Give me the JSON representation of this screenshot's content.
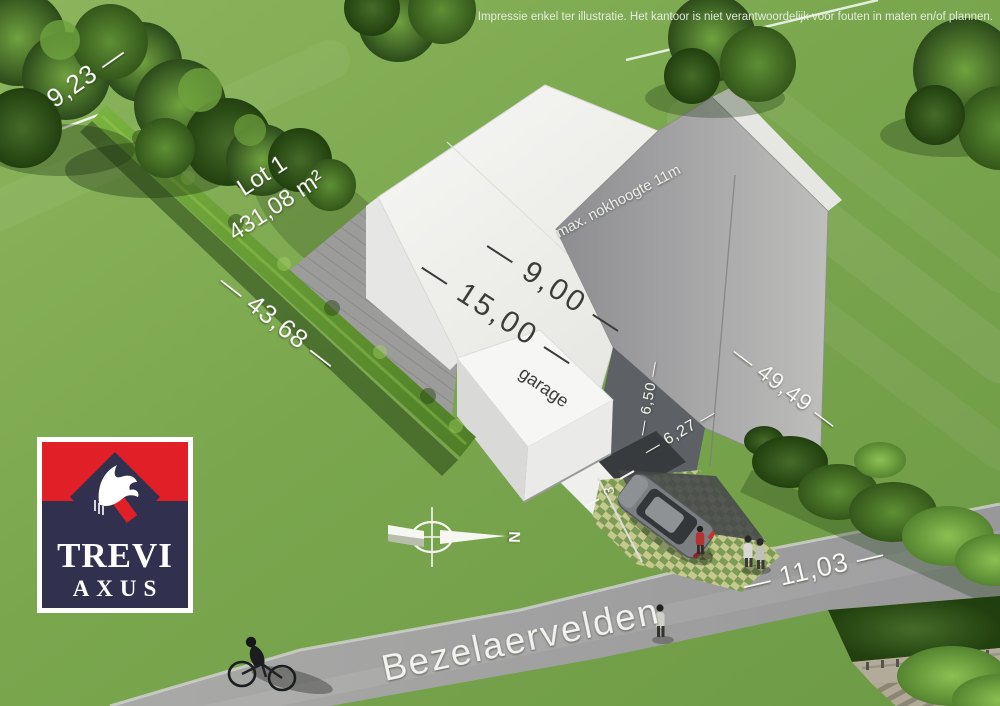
{
  "disclaimer": "Impressie enkel ter illustratie. Het kantoor is niet verantwoordelijk voor fouten in maten en/of plannen.",
  "lot": {
    "label": "Lot 1",
    "area": "431,08 m²"
  },
  "dimensions": {
    "rear": "9,23 —",
    "left": "— 43,68 —",
    "roof_depth": "— 9,00 —",
    "roof_width": "— 15,00 —",
    "ridge_note": "max. nokhoogte 11m",
    "garage": "garage",
    "wall_height": "— 6,50 —",
    "front": "— 6,27 —",
    "right": "— 49,49 —",
    "driveway": "3",
    "road_frontage": "— 11,03 —"
  },
  "street": {
    "name": "Bezelaervelden"
  },
  "compass": {
    "north": "N"
  },
  "logo": {
    "line1": "TREVI",
    "line2": "AXUS",
    "colors": {
      "red": "#e01f26",
      "navy": "#31304f",
      "white": "#ffffff"
    }
  },
  "palette": {
    "grass": "#7da550",
    "road": "#a3a3a1",
    "roof_white": "#f2f2f0",
    "roof_gray": "#a5a5a3",
    "dark_wall": "#5d6065",
    "hedge": "#5f9431",
    "paver_yellow": "#c5c98e"
  }
}
